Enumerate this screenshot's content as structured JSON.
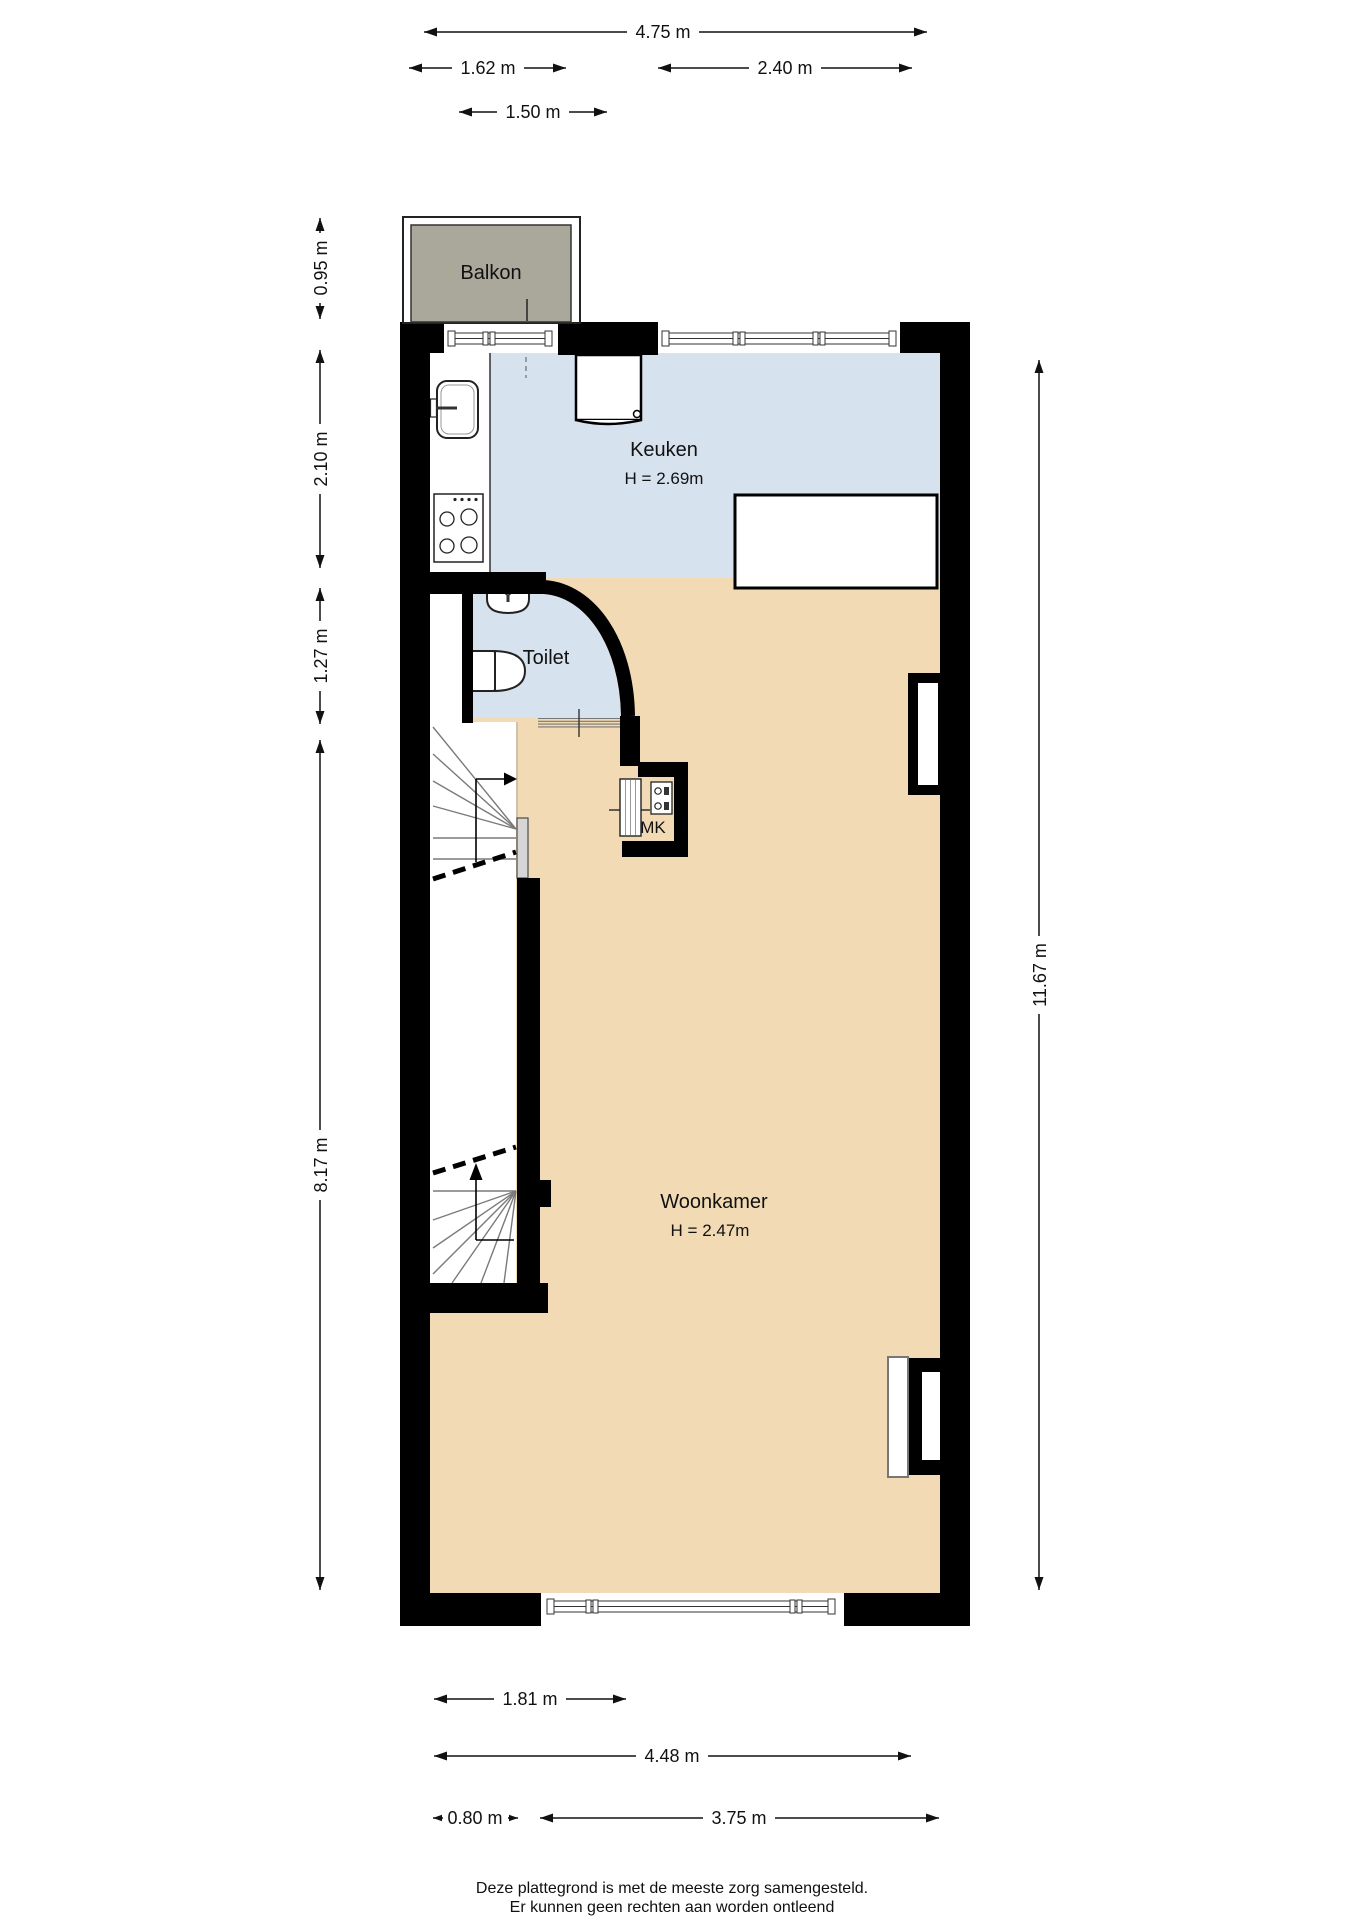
{
  "plan": {
    "footer_line1": "Deze plattegrond is met de meeste zorg samengesteld.",
    "footer_line2": "Er kunnen geen rechten aan worden ontleend"
  },
  "rooms": {
    "balkon": {
      "name": "Balkon"
    },
    "keuken": {
      "name": "Keuken",
      "height": "H = 2.69m"
    },
    "toilet": {
      "name": "Toilet"
    },
    "mk": {
      "name": "MK"
    },
    "woonkamer": {
      "name": "Woonkamer",
      "height": "H = 2.47m"
    }
  },
  "dimensions": {
    "top": [
      {
        "label": "4.75 m"
      },
      {
        "label": "1.62 m"
      },
      {
        "label": "2.40 m"
      },
      {
        "label": "1.50 m"
      }
    ],
    "left": [
      {
        "label": "0.95 m"
      },
      {
        "label": "2.10 m"
      },
      {
        "label": "1.27 m"
      },
      {
        "label": "8.17 m"
      }
    ],
    "right": [
      {
        "label": "11.67 m"
      }
    ],
    "bottom": [
      {
        "label": "1.81 m"
      },
      {
        "label": "4.48 m"
      },
      {
        "label": "0.80 m"
      },
      {
        "label": "3.75 m"
      }
    ]
  },
  "colors": {
    "floor": "#f2dbb4",
    "wet_room": "#d7e2ef",
    "balcony": "#a9a89b",
    "wall": "#000000"
  }
}
